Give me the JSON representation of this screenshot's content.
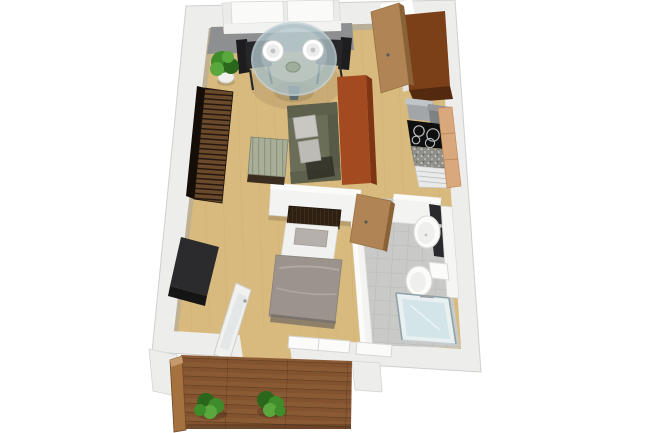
{
  "scene": {
    "type": "3d-floorplan-render",
    "view": "top-down perspective",
    "background": "#ffffff",
    "rooms": [
      "living-dining-room",
      "kitchen",
      "entry-hallway",
      "bedroom",
      "bathroom",
      "balcony"
    ],
    "counts": {
      "dining_chairs": 2,
      "dinner_plates": 2,
      "balcony_plants": 2,
      "indoor_plants": 1
    }
  },
  "objects": {
    "living_dining": [
      "white-sofa",
      "gray-rug",
      "round-glass-dining-table",
      "dinner-plates",
      "black-dining-chair-left",
      "black-dining-chair-right",
      "potted-plant",
      "wood-slat-sideboard",
      "striped-coffee-table",
      "olive-sofa",
      "orange-wardrobe"
    ],
    "kitchen": [
      "tall-brown-cabinet",
      "gray-appliances",
      "black-cooktop",
      "speckled-counter",
      "white-drawer-unit",
      "tan-cabinet",
      "entry-door-open"
    ],
    "bedroom": [
      "single-bed",
      "slatted-headboard",
      "taupe-blanket",
      "tv-lowboard",
      "balcony-door-open",
      "south-window"
    ],
    "bathroom": [
      "round-sink",
      "dark-vanity",
      "white-shelf-column",
      "toilet",
      "glass-shower",
      "bathroom-door-open",
      "tiled-floor"
    ],
    "balcony": [
      "wood-deck",
      "wood-railing",
      "deck-plant-left",
      "deck-plant-right"
    ]
  },
  "palette": {
    "background": "#ffffff",
    "wall_face": "#ededeb",
    "wall_interior": "#f3f3f1",
    "wall_interior_top": "#fbfbfa",
    "inner_shadow": "#a8a8a6",
    "floor_wood": "#d9ba7e",
    "plank_line": "#c9a967",
    "rug_gray": "#8e8f90",
    "tile": "#c9c9c7",
    "tile_grout": "#b4b4b2",
    "deck": "#8a5a35",
    "deck_line": "#5f3d20",
    "deck_tint": "#7a4c2a",
    "rail": "#a4713f",
    "rail_cap": "#c49a6b",
    "sofa_white": "#ebebe9",
    "cushion_white": "#fafaf9",
    "glass_table": "#a9bec3",
    "table_base": "#5c6a6e",
    "plate_white": "#ffffff",
    "plate_inner": "#ececec",
    "chair_black": "#1d1d1f",
    "chair_seat": "#27272a",
    "plant_green": "#3f8c2a",
    "plant_green_dark": "#2a661b",
    "plant_green_light": "#5aa83d",
    "pot_white": "#efefee",
    "sideboard_slat": "#6b4a2c",
    "sideboard_slat_dark": "#241810",
    "sideboard_side": "#140d08",
    "coffee_sage": "#a9ae97",
    "coffee_sage_dark": "#8f9480",
    "coffee_base": "#3a2d20",
    "sofa_olive": "#6a6d57",
    "sofa_olive_dark": "#565a46",
    "sofa_olive_arm": "#5d614c",
    "sofa_shadow": "#2f2f26",
    "pillow_gray": "#c9c7c2",
    "pillow_gray2": "#bdbbb5",
    "wardrobe_orange": "#a34a20",
    "wardrobe_orange_dark": "#7e3513",
    "kitchen_brown": "#7c4018",
    "kitchen_brown_dark": "#53290f",
    "kitchen_side_white": "#e3e3e1",
    "appliance_gray": "#a3a6a8",
    "appliance_gray_top": "#c2c5c7",
    "appliance_gray2": "#7e8284",
    "appliance_gray2_top": "#95989a",
    "cooktop_black": "#0f0f10",
    "burner_ring": "#b9bdbf",
    "counter_gray": "#90908a",
    "speckle_white": "#d8d8d2",
    "drawers_white": "#e9eaea",
    "drawer_line": "#c2c4c4",
    "cabinet_tan": "#d9a87c",
    "cabinet_tan_line": "#c08a5e",
    "door_tan": "#b08454",
    "door_tan_edge": "#8a6238",
    "bed_white": "#f1f1ef",
    "headboard_dark": "#2e2013",
    "headboard_slat": "#4a3520",
    "pillow_taupe": "#b5b0ab",
    "blanket_taupe": "#9b938c",
    "blanket_fold": "#b3aca6",
    "blanket_shadow": "#6f6862",
    "tv_dark": "#2b2b2d",
    "tv_front": "#151516",
    "fixture_white": "#fbfbfa",
    "fixture_inner": "#efefed",
    "vanity_dark": "#2a2a2c",
    "shelf_white": "#f5f5f3",
    "shower_glass": "#cfe3e6",
    "shower_base": "#e8f0f1",
    "shower_frame": "#8fa3a7",
    "window_white": "#fbfbfa"
  }
}
